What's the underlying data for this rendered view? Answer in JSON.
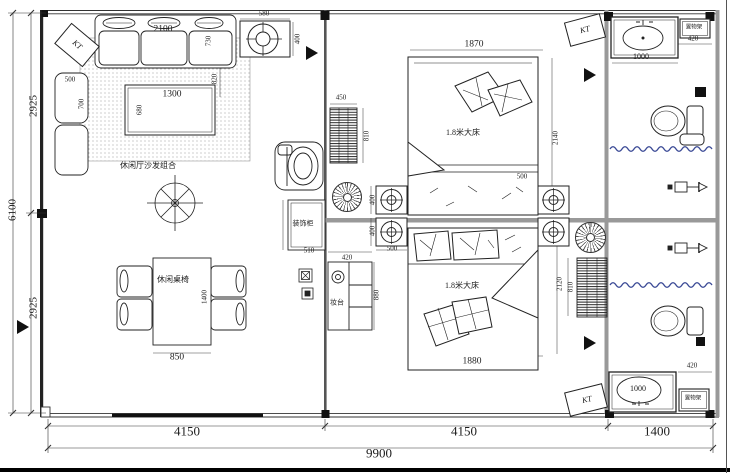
{
  "labels": {
    "kt": "KT",
    "living_sofa_area": "休闲厅沙发组合",
    "dining_set": "休闲桌椅",
    "bed_upper": "1.8米大床",
    "bed_lower": "1.8米大床",
    "cabinet": "装饰柜",
    "dresser": "妆台",
    "rack_top": "置物架",
    "rack_bottom": "置物架"
  },
  "dims": {
    "left_total": "6100",
    "left_upper": "2925",
    "left_lower": "2925",
    "bottom_left": "4150",
    "bottom_mid": "4150",
    "bottom_right": "1400",
    "bottom_total": "9900",
    "sofa_w": "2100",
    "sofa_d": "730",
    "sofa_gap": "820",
    "ac_top_w": "580",
    "ac_top_h": "400",
    "chair_w": "500",
    "chair_d": "700",
    "table_w": "1300",
    "table_d": "680",
    "dining_w": "850",
    "dining_l": "1400",
    "rack_upper_w": "450",
    "rack_upper_l": "810",
    "bed_upper_w": "1870",
    "bed_upper_l": "2140",
    "ac_mid_h1": "400",
    "ac_mid_h2": "400",
    "ac_mid_w1": "500",
    "ac_mid_w2": "500",
    "bed_lower_l": "2120",
    "rack_lower_l": "810",
    "bed_lower_w": "1880",
    "cabinet_w": "510",
    "dresser_w": "420",
    "dresser_l": "880",
    "sink_top_w": "1000",
    "rack_bath_top_w": "420",
    "sink_bottom_w": "1000",
    "rack_bath_bottom_w": "420"
  },
  "colors": {
    "curtain_blue": "#3b4a96",
    "wall_gray": "#999999",
    "line_dark": "#222222"
  }
}
